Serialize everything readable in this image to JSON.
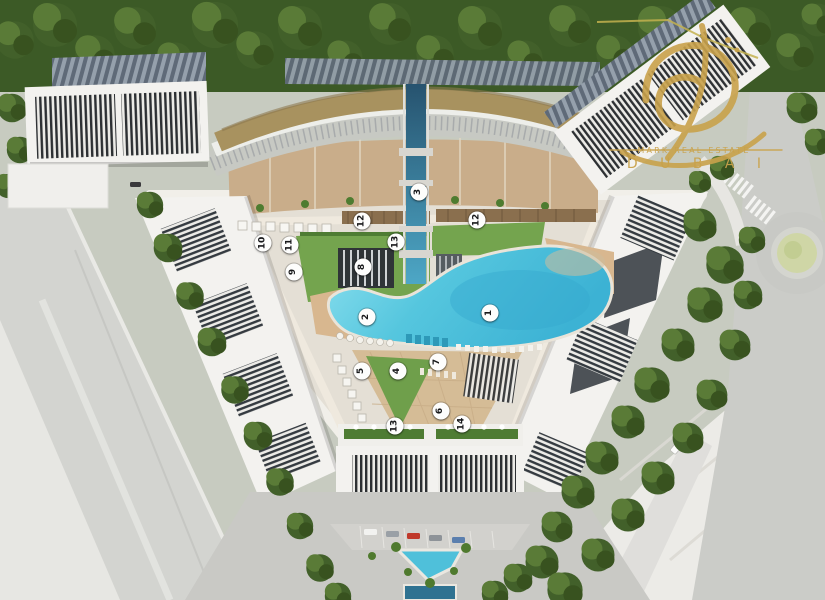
{
  "scene": {
    "title": "Aerial master-plan render of triangular residential development",
    "features": {
      "lagoon": "central crystal lagoon pool",
      "landscape": "lawns, sandy plaza, beach edges, cabanas",
      "context": "perimeter roads, roundabout, tree belts, highway"
    },
    "colors": {
      "lagoon": "#55c6de",
      "sand": "#d5bc96",
      "lawn": "#74a44e",
      "forest": "#3c5a26",
      "building_white": "#f3f2ef",
      "louver_dark": "#2d3033",
      "courtyard_tan": "#c9ad8a",
      "gold_roof": "#a8925f",
      "road_gray": "#cbccc8",
      "logo_gold": "#c9a24b"
    }
  },
  "watermark": {
    "line1": "MARK REAL ESTATE",
    "line2": "D U B A I"
  },
  "markers": [
    {
      "label": "1",
      "x": 490,
      "y": 313
    },
    {
      "label": "2",
      "x": 367,
      "y": 317
    },
    {
      "label": "3",
      "x": 419,
      "y": 192
    },
    {
      "label": "4",
      "x": 398,
      "y": 371
    },
    {
      "label": "5",
      "x": 362,
      "y": 371
    },
    {
      "label": "6",
      "x": 441,
      "y": 411
    },
    {
      "label": "7",
      "x": 438,
      "y": 362
    },
    {
      "label": "8",
      "x": 363,
      "y": 267
    },
    {
      "label": "9",
      "x": 294,
      "y": 272
    },
    {
      "label": "10",
      "x": 263,
      "y": 243
    },
    {
      "label": "11",
      "x": 290,
      "y": 245
    },
    {
      "label": "12",
      "x": 362,
      "y": 221
    },
    {
      "label": "12",
      "x": 477,
      "y": 220
    },
    {
      "label": "13",
      "x": 396,
      "y": 242
    },
    {
      "label": "13",
      "x": 395,
      "y": 426
    },
    {
      "label": "14",
      "x": 462,
      "y": 424
    }
  ]
}
